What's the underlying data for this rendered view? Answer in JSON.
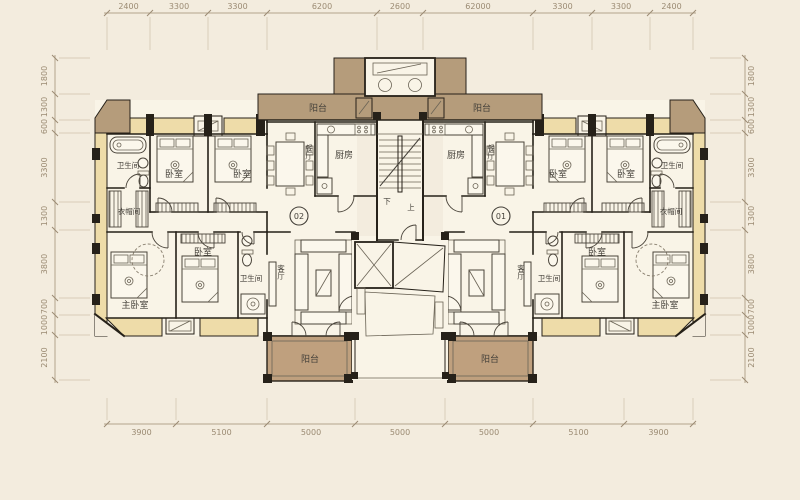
{
  "plan": {
    "rooms": {
      "balcony": "阳台",
      "kitchen": "厨房",
      "dining_room": "餐厅",
      "bedroom": "卧室",
      "master_bedroom": "主卧室",
      "living_room": "客厅",
      "bathroom": "卫生间",
      "cloakroom": "衣帽间"
    },
    "stairs": {
      "down": "下",
      "up": "上"
    },
    "units": {
      "left_number": "02",
      "right_number": "01"
    }
  },
  "dimensions": {
    "top": [
      "2400",
      "3300",
      "3300",
      "6200",
      "2600",
      "62000",
      "3300",
      "3300",
      "2400"
    ],
    "bottom": [
      "3900",
      "5100",
      "5000",
      "5000",
      "5000",
      "5100",
      "3900"
    ],
    "left": [
      "1800",
      "1300",
      "600",
      "3300",
      "1300",
      "3800",
      "700",
      "1000",
      "2100"
    ],
    "right": [
      "1800",
      "1300",
      "600",
      "3300",
      "1300",
      "3800",
      "700",
      "1000",
      "2100"
    ]
  },
  "colors": {
    "background": "#f3ecde",
    "floor": "#f9f4e7",
    "balcony_tan": "#b59c7b",
    "balcony_dark": "#bfa07e",
    "bay_window_yellow": "#eedca9",
    "wall_black": "#262119",
    "dimension_text": "#9b8b73",
    "label_text": "#45413a"
  }
}
